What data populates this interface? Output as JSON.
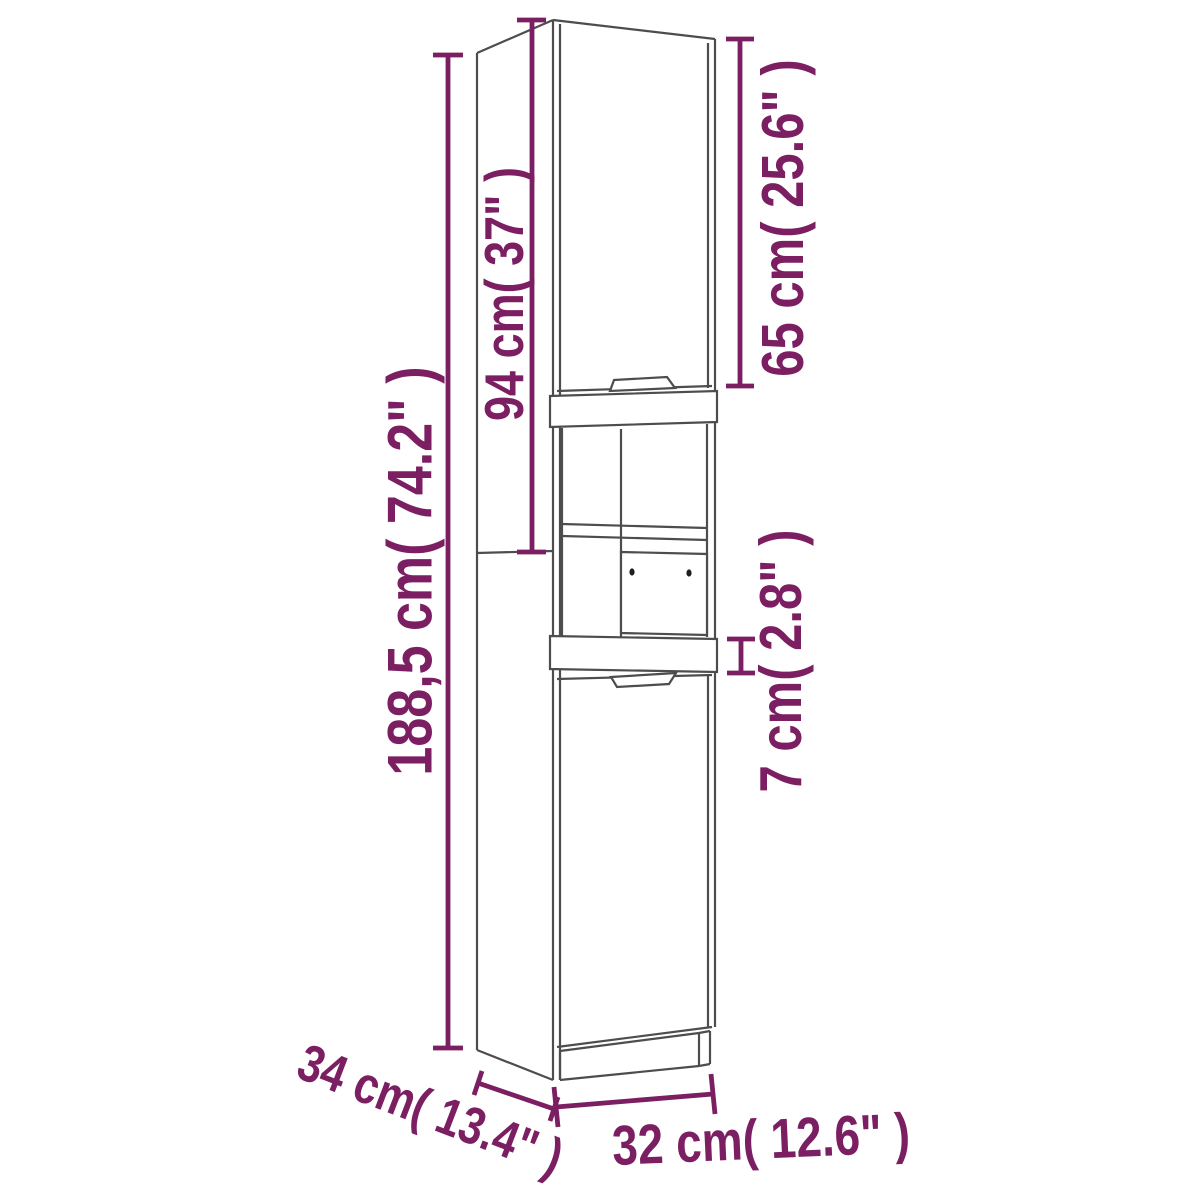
{
  "figure": "Tall bathroom cabinet technical line drawing with dimension annotations",
  "colors": {
    "background": "#ffffff",
    "dimension_accent": "#7b1e62",
    "cabinet_line": "#4d4d4d",
    "handle_hole": "#1f1f1f"
  },
  "dimensions": {
    "total_height": {
      "label": "188,5 cm( 74.2\" )"
    },
    "upper_section_height": {
      "label": "94 cm( 37\" )"
    },
    "top_door_height": {
      "label": "65 cm( 25.6\" )"
    },
    "rail_height": {
      "label": "7 cm( 2.8\" )"
    },
    "depth": {
      "label": "34 cm( 13.4\" )"
    },
    "width": {
      "label": "32 cm( 12.6\" )"
    }
  }
}
